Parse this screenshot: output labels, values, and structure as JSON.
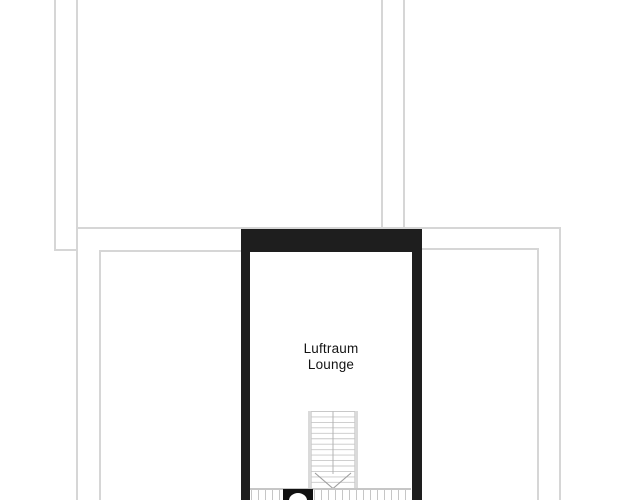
{
  "floor_plan": {
    "room": {
      "name_line1": "Luftraum",
      "name_line2": "Lounge"
    },
    "staircase": {
      "tread_count": 14,
      "arrow_icon": "chevron-down-icon"
    },
    "colors": {
      "background": "#ffffff",
      "wall": "#1e1e1e",
      "outline": "#d6d6d6",
      "stair_frame": "#aeaeae",
      "stair_tread": "#c8c8c8",
      "arrow": "#9e9e9e",
      "tick": "#c6c6c6",
      "label": "#141414",
      "fixture": "#111111"
    }
  }
}
